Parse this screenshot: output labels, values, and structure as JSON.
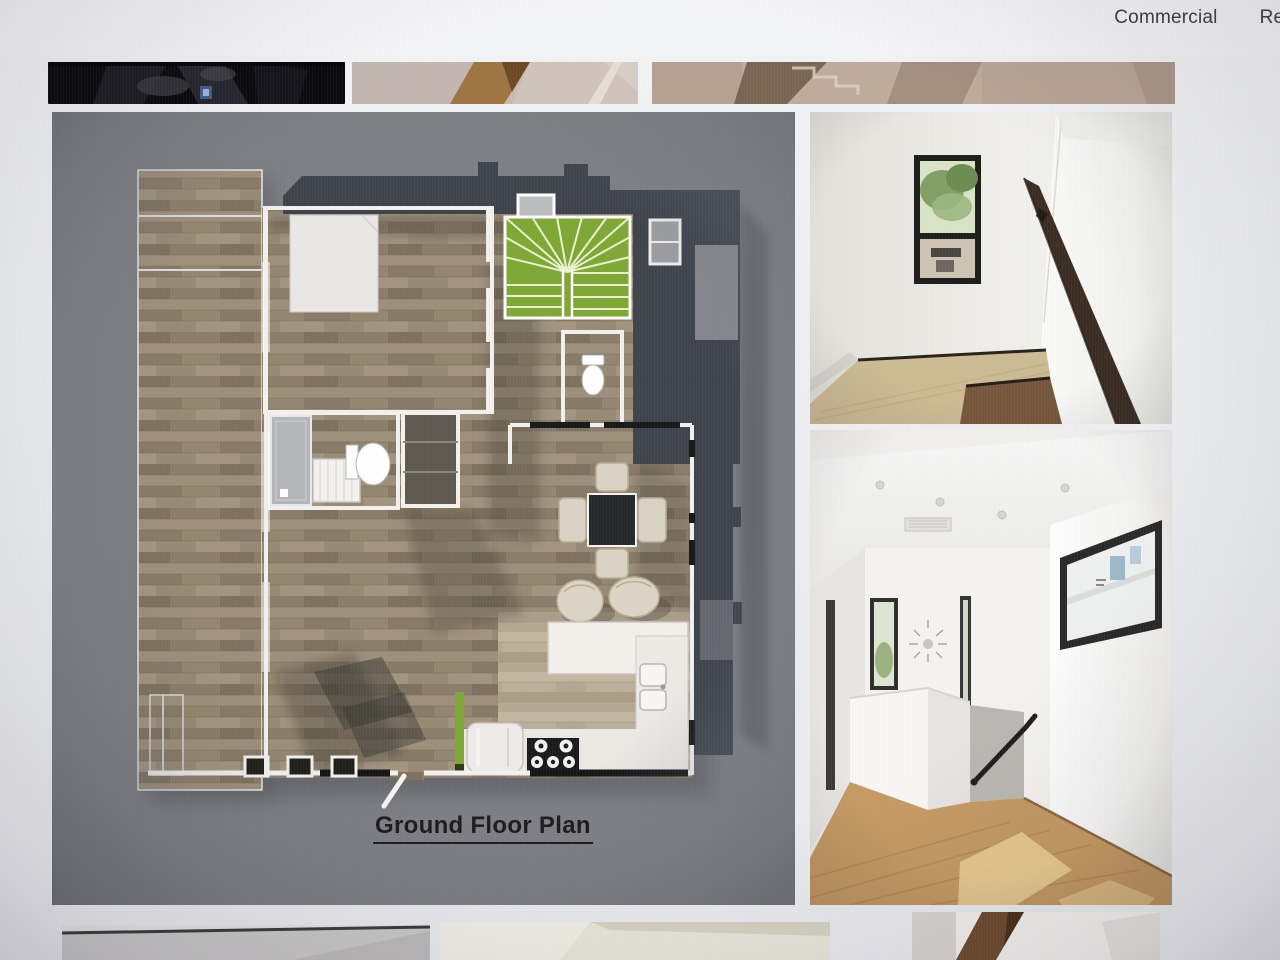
{
  "header": {
    "nav_items": [
      {
        "label": "Commercial"
      },
      {
        "label": "Res"
      }
    ]
  },
  "gallery": {
    "caption": "Ground Floor Plan",
    "top_thumbnails": [
      {
        "name": "dark-interior-photo"
      },
      {
        "name": "carpet-stair-photo"
      },
      {
        "name": "stairwell-wall-photo"
      }
    ],
    "main_images": [
      {
        "name": "ground-floor-plan-render"
      },
      {
        "name": "stair-landing-window-photo"
      },
      {
        "name": "upstairs-hallway-photo"
      }
    ],
    "bottom_thumbnails": [
      {
        "name": "grey-wall-photo"
      },
      {
        "name": "cream-interior-photo"
      },
      {
        "name": "stair-rail-photo"
      }
    ]
  },
  "colors": {
    "page_background": "#eceef0",
    "plan_background": "#7b7d82",
    "roof_dark": "#3f444c",
    "stair_green": "#7ea733",
    "wood_plank": "#958874",
    "hall_floor_wood": "#c69a62",
    "handrail_brown": "#3b2d22",
    "nav_text": "#3d3d40"
  }
}
